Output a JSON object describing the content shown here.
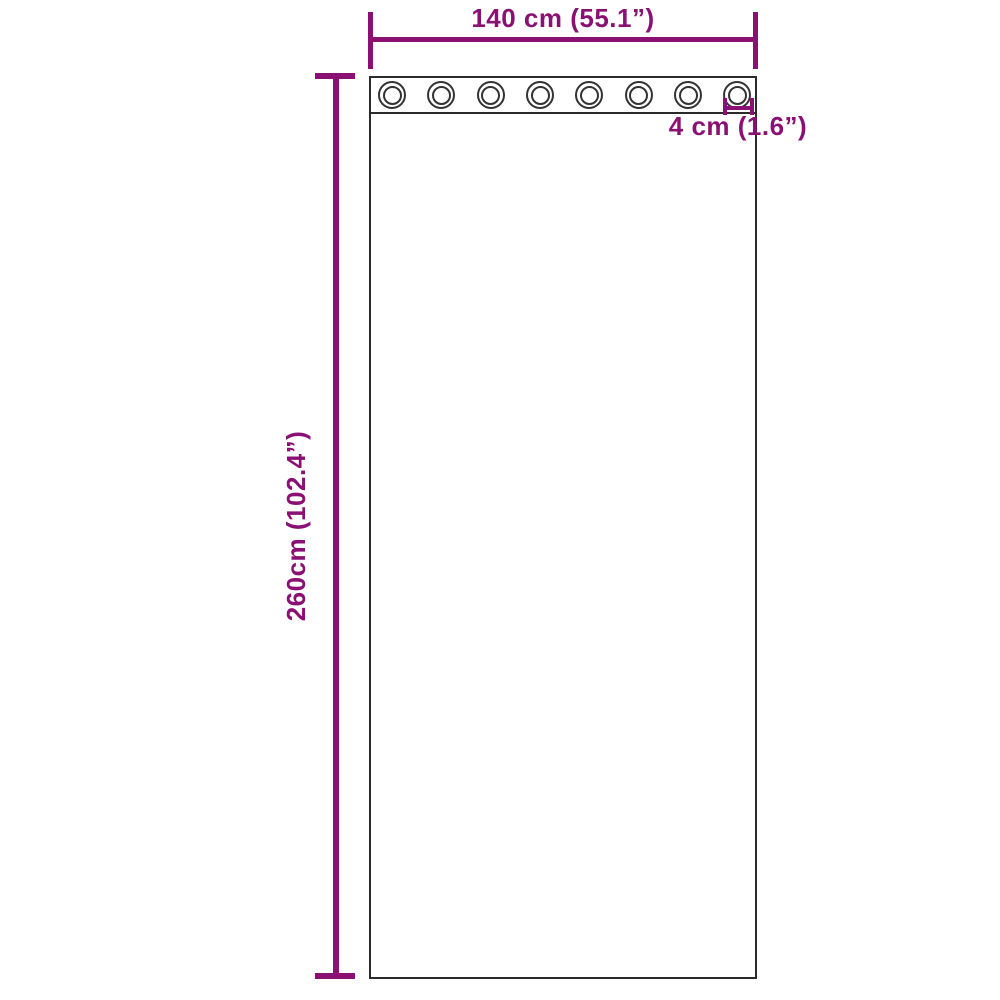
{
  "diagram": {
    "type": "product-dimension-diagram",
    "subject": "grommet-curtain",
    "dimensions": {
      "width": {
        "label": "140 cm (55.1”)",
        "value_cm": 140,
        "value_in": 55.1
      },
      "height": {
        "label": "260cm (102.4”)",
        "value_cm": 260,
        "value_in": 102.4
      },
      "grommet": {
        "label": "4 cm (1.6”)",
        "value_cm": 4,
        "value_in": 1.6
      }
    },
    "grommets": {
      "count": 8
    },
    "colors": {
      "dimension": "#8a1173",
      "outline": "#2b2b2b",
      "background": "#ffffff"
    }
  }
}
